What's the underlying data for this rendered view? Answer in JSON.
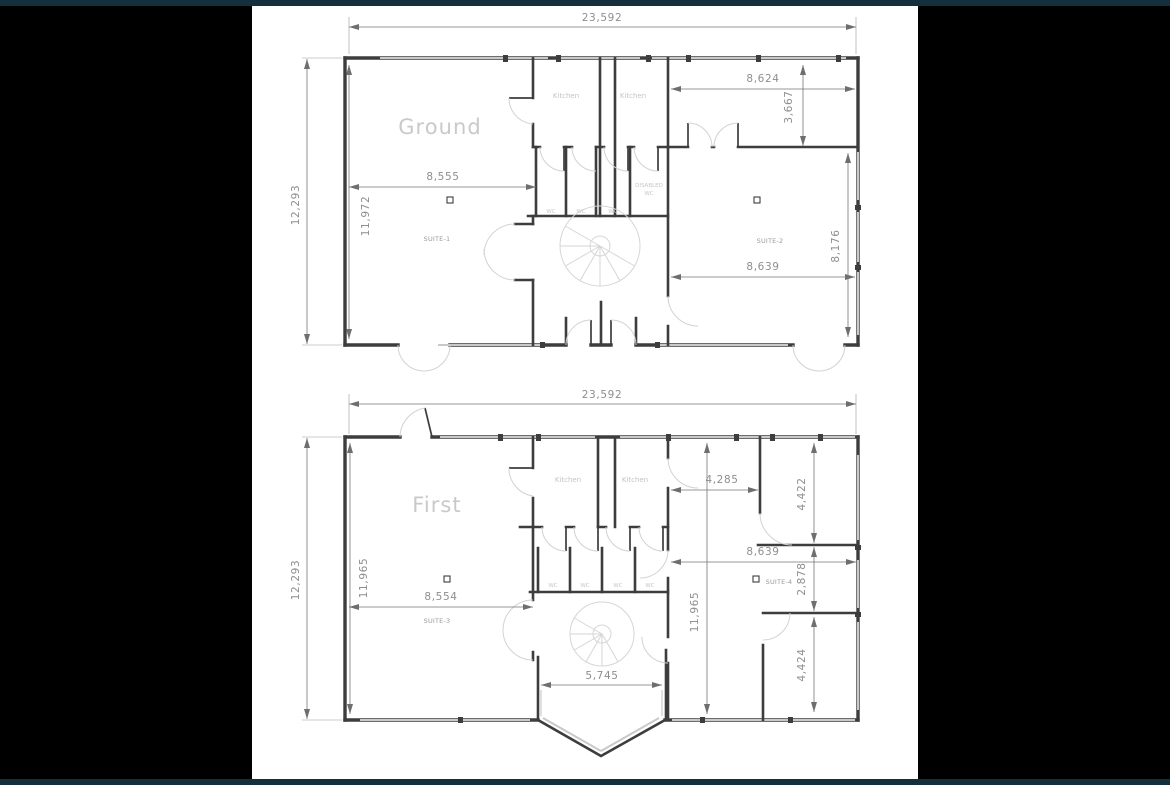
{
  "window": {
    "background": "#000000",
    "top_strip_color": "#14303d",
    "bottom_strip_color": "#14303d",
    "paper_color": "#ffffff"
  },
  "drawing_colors": {
    "wall_line": "#3d3d3d",
    "light_line": "#c9c9c9",
    "dimension_text": "#8e8e8e",
    "title_text": "#c9c9c9"
  },
  "ground_floor": {
    "title": "Ground",
    "dimensions": {
      "overall_width": "23,592",
      "overall_height": "12,293",
      "interior_height": "11,972",
      "suite1_width": "8,555",
      "top_right_room_width": "8,624",
      "top_right_room_height": "3,667",
      "suite2_width": "8,639",
      "suite2_height": "8,176"
    },
    "labels": {
      "kitchen_left": "Kitchen",
      "kitchen_right": "Kitchen",
      "wc_1": "WC",
      "wc_2": "WC",
      "wc_3": "WC",
      "disabled_wc_line1": "DISABLED",
      "disabled_wc_line2": "WC",
      "suite_1": "SUITE-1",
      "suite_2": "SUITE-2"
    }
  },
  "first_floor": {
    "title": "First",
    "dimensions": {
      "overall_width": "23,592",
      "overall_height": "12,293",
      "interior_height_left": "11,965",
      "interior_height_center": "11,965",
      "suite3_width": "8,554",
      "top_right_room_width": "4,285",
      "top_right_room_height": "4,422",
      "suite4_width": "8,639",
      "suite4_height": "2,878",
      "bottom_right_room_height": "4,424",
      "bay_opening_width": "5,745"
    },
    "labels": {
      "kitchen_left": "Kitchen",
      "kitchen_right": "Kitchen",
      "wc_1": "WC",
      "wc_2": "WC",
      "wc_3": "WC",
      "wc_4": "WC",
      "suite_3": "SUITE-3",
      "suite_4": "SUITE-4"
    }
  }
}
